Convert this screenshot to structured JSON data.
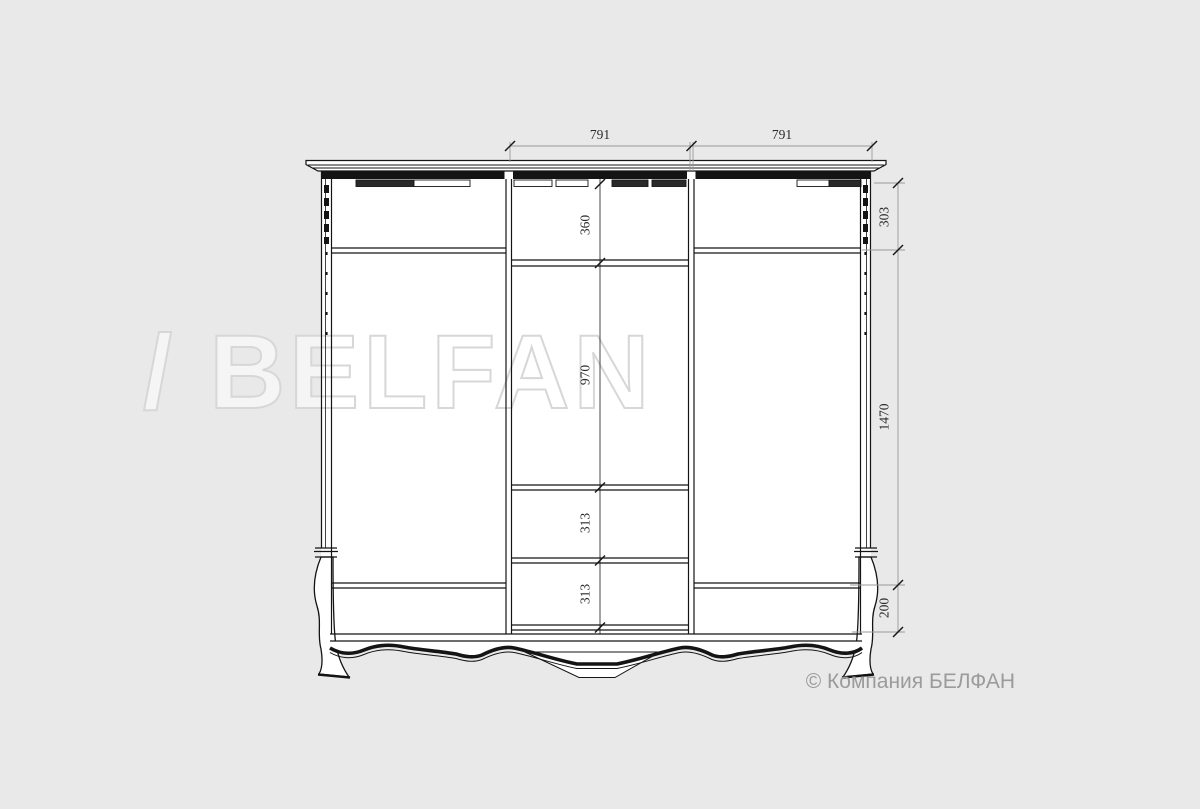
{
  "page": {
    "background_color": "#e9e9e9",
    "line_color": "#141414",
    "dimension_line_color": "#999999"
  },
  "drawing": {
    "subject": "wardrobe-front-elevation-technical-drawing",
    "dim_top": [
      {
        "label": "791"
      },
      {
        "label": "791"
      }
    ],
    "dim_right": [
      {
        "label": "303"
      },
      {
        "label": "1470"
      },
      {
        "label": "200"
      }
    ],
    "dim_inner": [
      {
        "label": "360"
      },
      {
        "label": "970"
      },
      {
        "label": "313"
      },
      {
        "label": "313"
      }
    ]
  },
  "watermark": {
    "text": "/ BELFAN"
  },
  "footer": {
    "copyright": "© Компания БЕЛФАН"
  }
}
